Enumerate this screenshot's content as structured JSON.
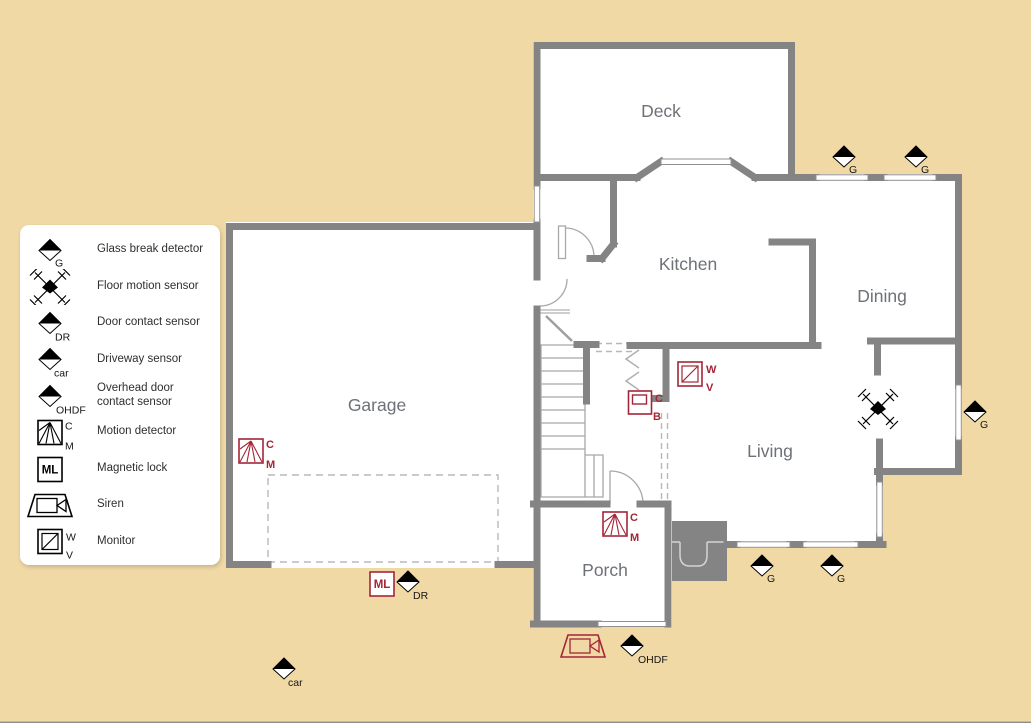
{
  "colors": {
    "background": "#f1d9a6",
    "wall": "#848484",
    "device_red": "#a32638",
    "room_label": "#6e7177",
    "legend_panel": "#ffffff",
    "legend_text": "#2e2e2e",
    "sensor_black": "#000000"
  },
  "legend": {
    "items": [
      {
        "type": "glass-break",
        "tag": "G",
        "label": "Glass break detector"
      },
      {
        "type": "floor-motion",
        "label": "Floor motion sensor"
      },
      {
        "type": "door-contact",
        "tag": "DR",
        "label": "Door contact sensor"
      },
      {
        "type": "driveway",
        "tag": "car",
        "label": "Driveway sensor"
      },
      {
        "type": "overhead-door",
        "tag": "OHDF",
        "label": "Overhead door contact sensor"
      },
      {
        "type": "motion-detector",
        "tags": [
          "C",
          "M"
        ],
        "label": "Motion detector"
      },
      {
        "type": "magnetic-lock",
        "tag": "ML",
        "label": "Magnetic lock"
      },
      {
        "type": "siren",
        "label": "Siren"
      },
      {
        "type": "monitor",
        "tags": [
          "W",
          "V"
        ],
        "label": "Monitor"
      }
    ]
  },
  "rooms": [
    {
      "name": "Deck"
    },
    {
      "name": "Kitchen"
    },
    {
      "name": "Dining"
    },
    {
      "name": "Garage"
    },
    {
      "name": "Living"
    },
    {
      "name": "Porch"
    }
  ],
  "sensors": [
    {
      "type": "glass-break",
      "x": 844,
      "y": 157,
      "tag": "G"
    },
    {
      "type": "glass-break",
      "x": 916,
      "y": 157,
      "tag": "G"
    },
    {
      "type": "glass-break",
      "x": 975,
      "y": 412,
      "tag": "G"
    },
    {
      "type": "glass-break",
      "x": 762,
      "y": 566,
      "tag": "G"
    },
    {
      "type": "glass-break",
      "x": 832,
      "y": 566,
      "tag": "G"
    },
    {
      "type": "floor-motion",
      "x": 878,
      "y": 409
    },
    {
      "type": "door-contact",
      "x": 408,
      "y": 582,
      "tag": "DR"
    },
    {
      "type": "driveway",
      "x": 284,
      "y": 669,
      "tag": "car"
    },
    {
      "type": "overhead-door",
      "x": 632,
      "y": 646,
      "tag": "OHDF"
    },
    {
      "type": "magnetic-lock",
      "x": 382,
      "y": 584,
      "tag": "ML"
    },
    {
      "type": "siren",
      "x": 583,
      "y": 646
    },
    {
      "type": "motion-detector",
      "x": 251,
      "y": 451,
      "tags": [
        "C",
        "M"
      ]
    },
    {
      "type": "motion-detector",
      "x": 615,
      "y": 524,
      "tags": [
        "C",
        "M"
      ]
    },
    {
      "type": "monitor",
      "x": 690,
      "y": 374,
      "tags": [
        "W",
        "V"
      ]
    },
    {
      "type": "control-box",
      "x": 640,
      "y": 402,
      "tags": [
        "C",
        "B"
      ]
    }
  ]
}
